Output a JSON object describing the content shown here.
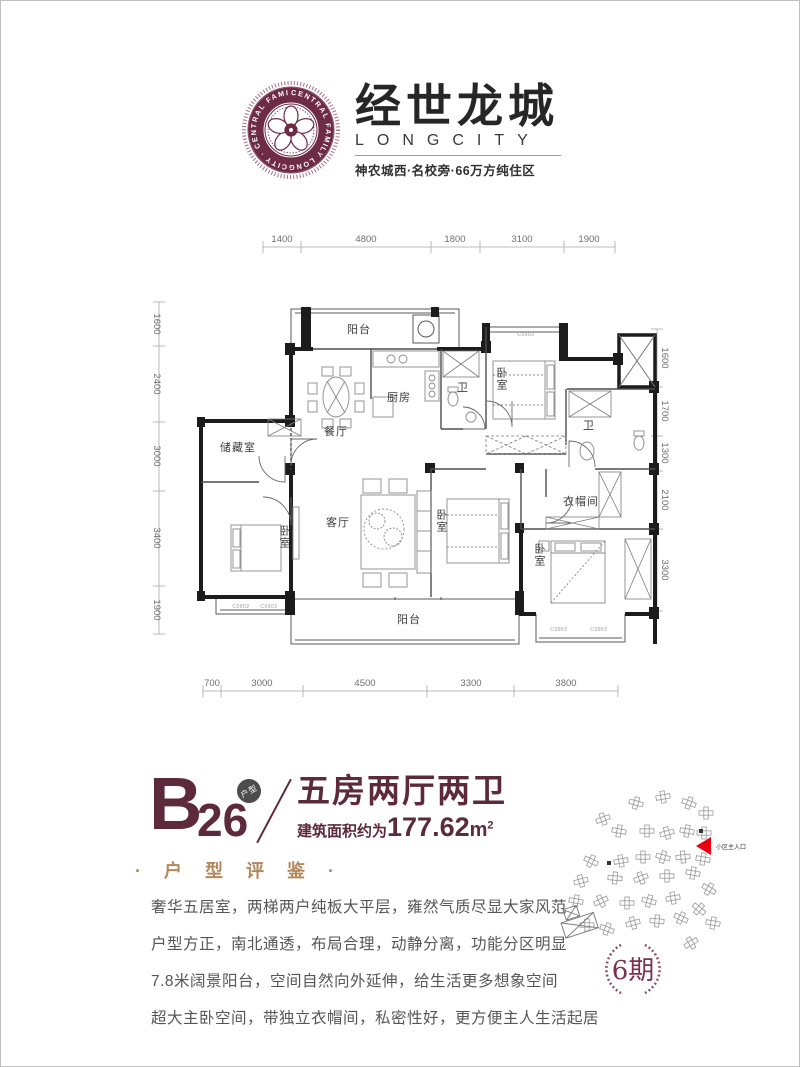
{
  "header": {
    "brand_cn": "经世龙城",
    "brand_en": "LONGCITY",
    "tagline": "神农城西·名校旁·66万方纯住区",
    "seal_ring_text": "CENTRAL FAMILY LONGCITY · CENTRAL FAMILY LONGCITY ·"
  },
  "floorplan": {
    "dims": {
      "top": [
        "1400",
        "4800",
        "1800",
        "3100",
        "1900"
      ],
      "bottom": [
        "700",
        "3000",
        "4500",
        "3300",
        "3800"
      ],
      "left": [
        "1600",
        "2400",
        "3000",
        "3400",
        "1900"
      ],
      "right": [
        "1600",
        "1700",
        "1300",
        "2100",
        "3300"
      ]
    },
    "rooms": {
      "balcony_n": "阳台",
      "kitchen": "厨房",
      "bath_a": "卫",
      "bedroom_ne": "卧室",
      "bath_b": "卫",
      "dining": "餐厅",
      "storage": "储藏室",
      "living": "客厅",
      "bedroom_w": "卧室",
      "bedroom_m": "卧室",
      "cloakroom": "衣帽间",
      "bedroom_master": "卧室",
      "balcony_s": "阳台"
    },
    "window_code": "C0902"
  },
  "unit": {
    "code_letter": "B",
    "code_number": "26",
    "badge": "户型",
    "title": "五房两厅两卫",
    "area_label": "建筑面积约为",
    "area_value": "177.62",
    "area_unit": "m",
    "area_exp": "2"
  },
  "review": {
    "heading": "· 户 型 评 鉴 ·",
    "lines": [
      "奢华五居室，两梯两户纯板大平层，雍然气质尽显大家风范",
      "户型方正，南北通透，布局合理，动静分离，功能分区明显",
      "7.8米阔景阳台，空间自然向外延伸，给生活更多想象空间",
      "超大主卧空间，带独立衣帽间，私密性好，更方便主人生活起居"
    ]
  },
  "siteplan": {
    "entrance_label": "小区主入口",
    "phase": "6期"
  }
}
